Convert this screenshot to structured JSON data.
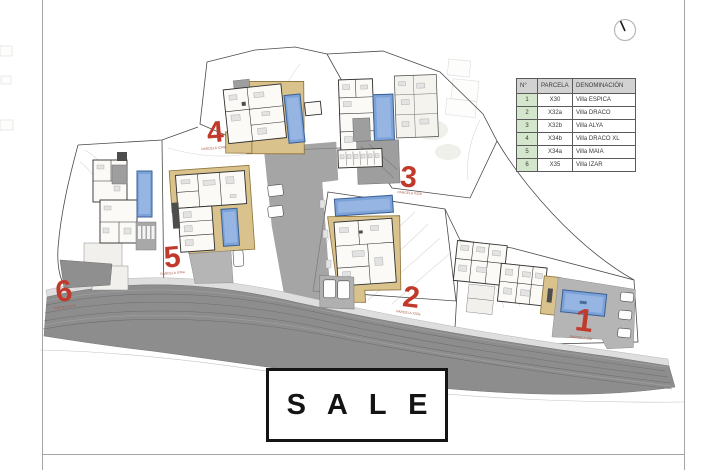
{
  "legend_table": {
    "headers": [
      "N°",
      "PARCELA",
      "DENOMINACIÓN"
    ],
    "rows": [
      {
        "n": "1",
        "parcela": "X30",
        "denominacion": "Villa ESPICA"
      },
      {
        "n": "2",
        "parcela": "X32a",
        "denominacion": "Villa DRACO"
      },
      {
        "n": "3",
        "parcela": "X32b",
        "denominacion": "Villa ALYA"
      },
      {
        "n": "4",
        "parcela": "X34b",
        "denominacion": "Villa DRACO XL"
      },
      {
        "n": "5",
        "parcela": "X34a",
        "denominacion": "Villa MAIA"
      },
      {
        "n": "6",
        "parcela": "X35",
        "denominacion": "Villa IZAR"
      }
    ],
    "colors": {
      "header_bg": "#d2d2d2",
      "number_column_bg": "#d4e6cc",
      "border": "#5a5a5a"
    }
  },
  "sale_banner": {
    "label": "S A L E"
  },
  "plan": {
    "markers": [
      {
        "number": "1",
        "label": "PARCELA X30"
      },
      {
        "number": "2",
        "label": "PARCELA X32a"
      },
      {
        "number": "3",
        "label": "PARCELA X32b"
      },
      {
        "number": "4",
        "label": "PARCELA X34b"
      },
      {
        "number": "5",
        "label": "PARCELA X34a"
      },
      {
        "number": "6",
        "label": "PARCELA X35"
      }
    ],
    "colors": {
      "marker_red": "#c0392b",
      "pool_blue": "#7ba3d9",
      "villa_wall_tan": "#d9c28c",
      "road_gray": "#8d8d8d"
    }
  }
}
